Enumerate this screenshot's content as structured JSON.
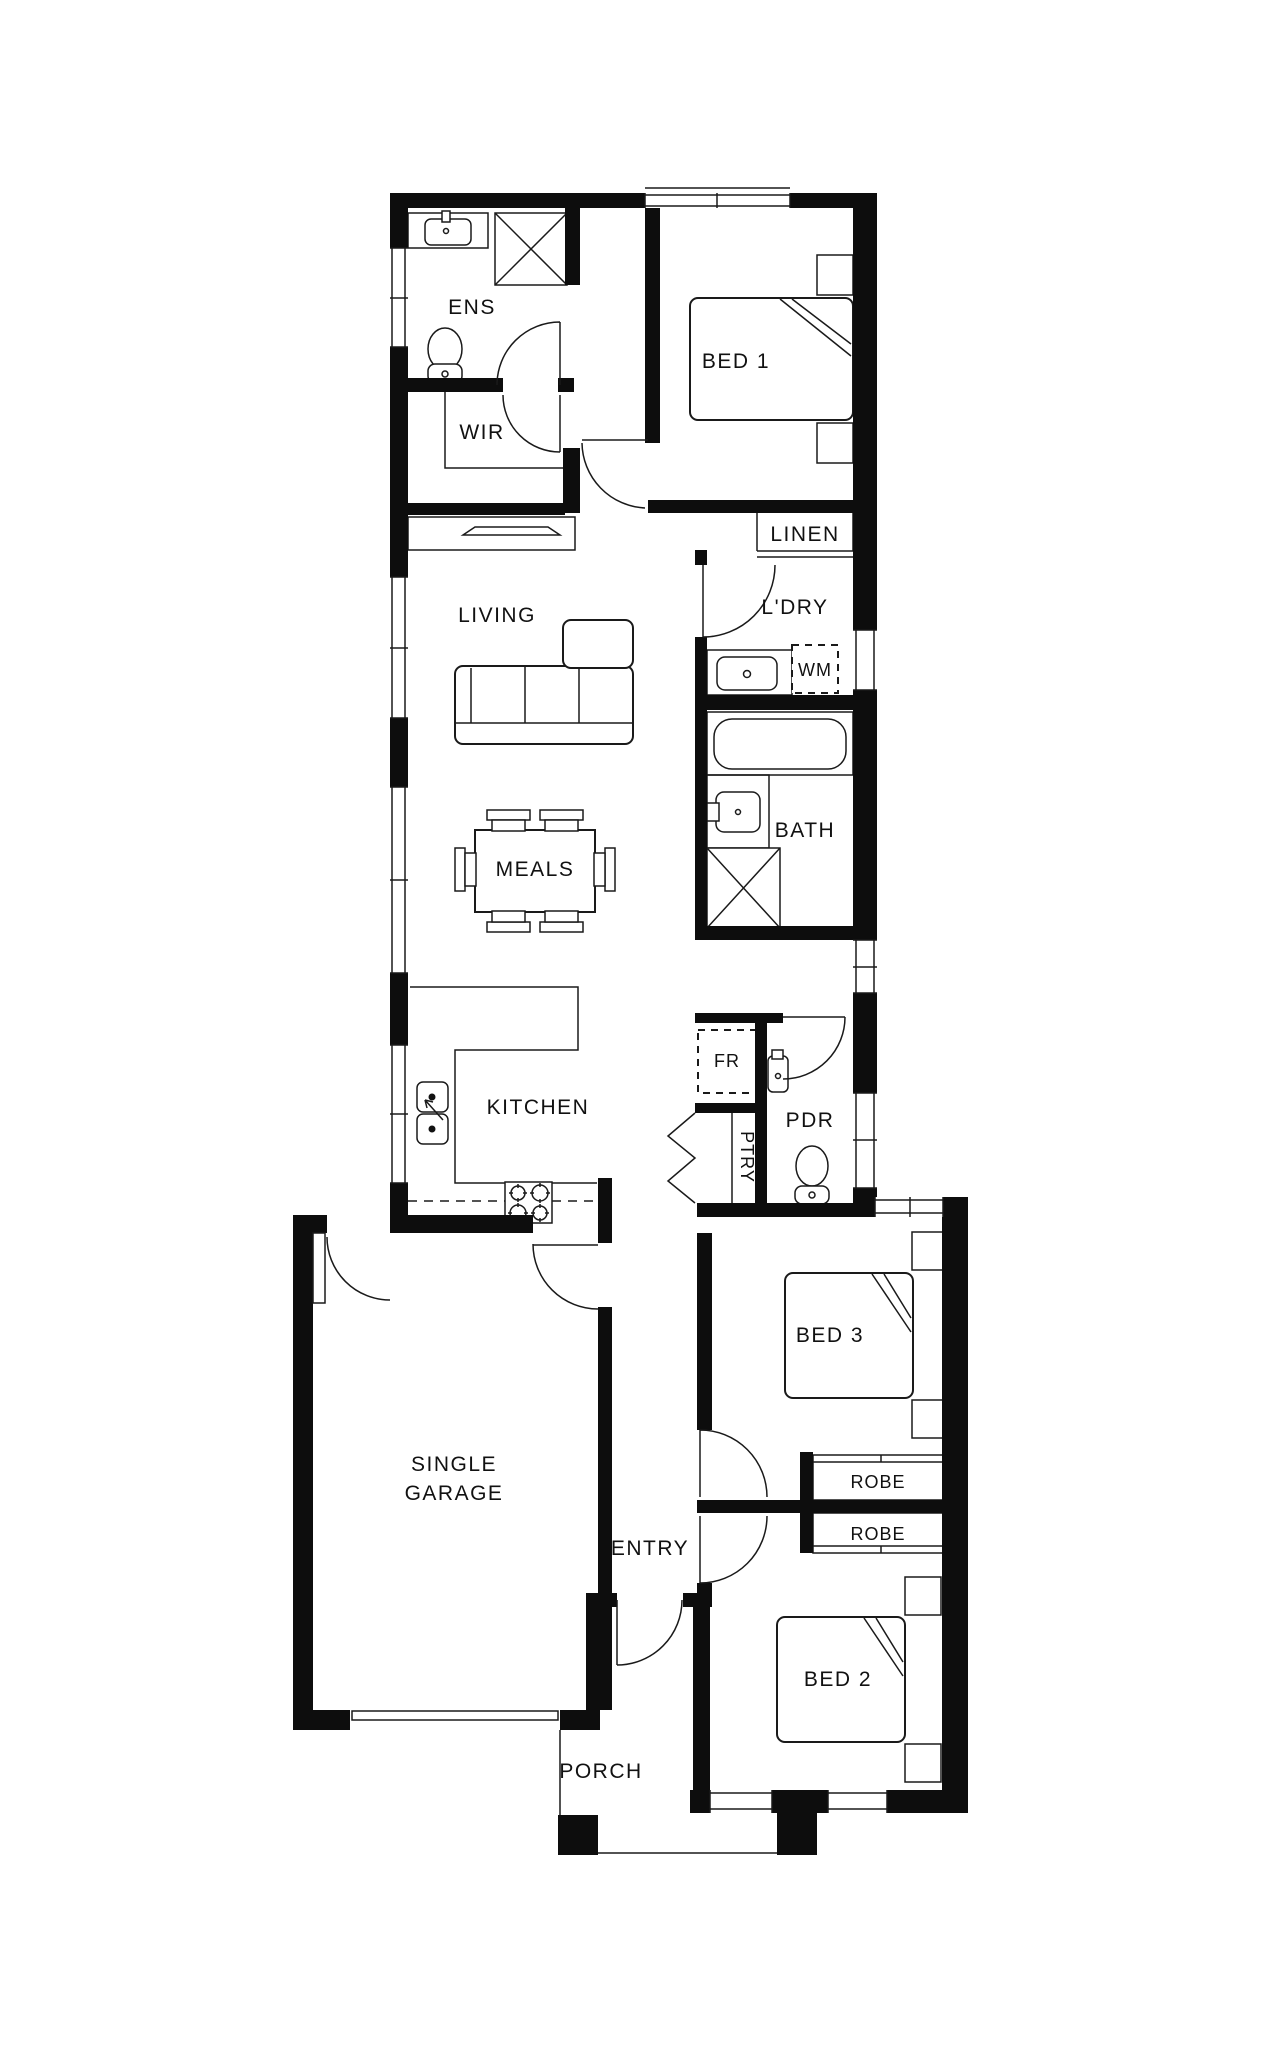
{
  "plan": {
    "type": "residential-floor-plan",
    "colors": {
      "wall": "#0d0d0d",
      "line": "#1a1a1a",
      "background": "#ffffff",
      "text": "#111111"
    },
    "rooms": {
      "ens": "ENS",
      "wir": "WIR",
      "bed1": "BED 1",
      "linen": "LINEN",
      "ldry": "L'DRY",
      "living": "LIVING",
      "wm": "WM",
      "bath": "BATH",
      "meals": "MEALS",
      "kitchen": "KITCHEN",
      "fr": "FR",
      "pdr": "PDR",
      "ptry": "PTRY",
      "garage_line1": "SINGLE",
      "garage_line2": "GARAGE",
      "bed3": "BED 3",
      "robe1": "ROBE",
      "robe2": "ROBE",
      "entry": "ENTRY",
      "bed2": "BED 2",
      "porch": "PORCH"
    }
  }
}
